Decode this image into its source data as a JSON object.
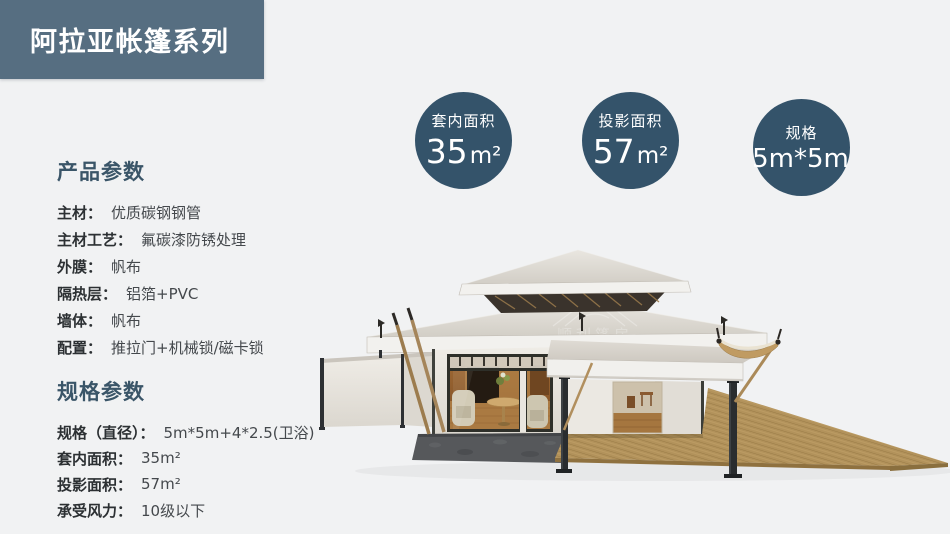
{
  "banner": {
    "title": "阿拉亚帐篷系列",
    "bg_color": "#566e81",
    "text_color": "#ffffff"
  },
  "badges": [
    {
      "label": "套内面积",
      "value": "35",
      "unit": "m²"
    },
    {
      "label": "投影面积",
      "value": "57",
      "unit": "m²"
    },
    {
      "label": "规格",
      "value": "5m*5m",
      "unit": ""
    }
  ],
  "badge_bg_color": "#34536a",
  "sections": [
    {
      "heading": "产品参数",
      "items": [
        {
          "label": "主材：",
          "value": "优质碳钢钢管"
        },
        {
          "label": "主材工艺：",
          "value": "氟碳漆防锈处理"
        },
        {
          "label": "外膜：",
          "value": "帆布"
        },
        {
          "label": "隔热层：",
          "value": "铝箔+PVC"
        },
        {
          "label": "墙体：",
          "value": "帆布"
        },
        {
          "label": "配置：",
          "value": "推拉门+机械锁/磁卡锁"
        }
      ]
    },
    {
      "heading": "规格参数",
      "items": [
        {
          "label": "规格（直径）：",
          "value": "5m*5m+4*2.5(卫浴)"
        },
        {
          "label": "套内面积：",
          "value": "35m²"
        },
        {
          "label": "投影面积：",
          "value": "57m²"
        },
        {
          "label": "承受风力：",
          "value": "10级以下"
        }
      ]
    }
  ],
  "heading_color": "#3a5568",
  "watermark": {
    "cjk": "顺利篷房",
    "latin": "WELL TENT"
  }
}
